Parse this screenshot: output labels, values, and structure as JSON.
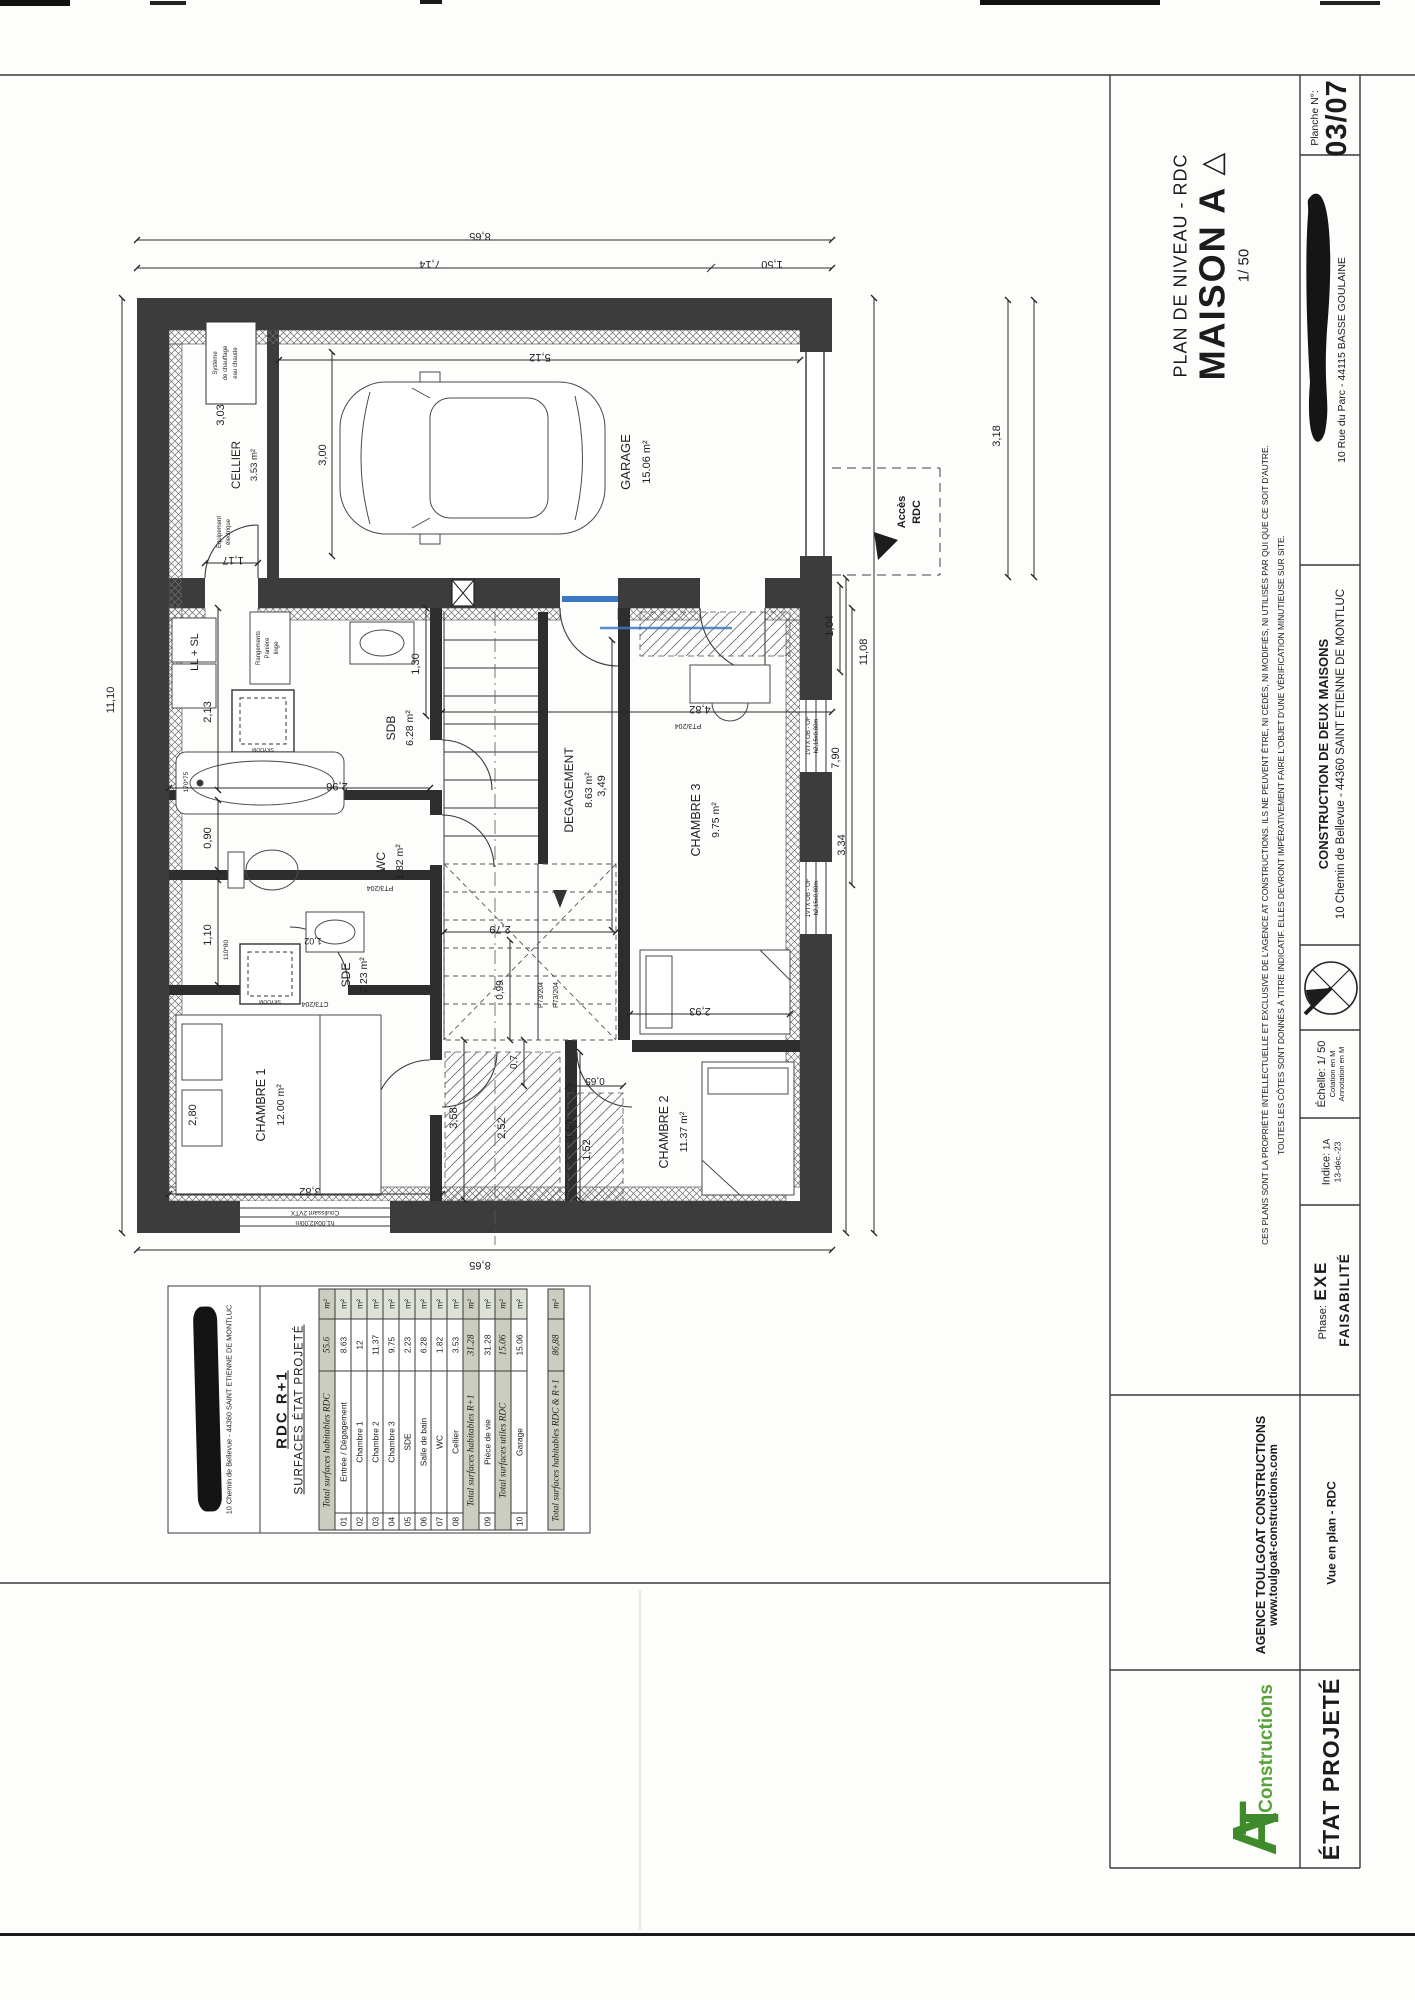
{
  "titleblock": {
    "title_small": "PLAN DE NIVEAU - RDC",
    "title_big": "MAISON A",
    "triangle": "△",
    "scale": "1/ 50",
    "planche_label": "Planche N°:",
    "planche_value": "03/07",
    "site_address": "10 Rue du Parc - 44115 BASSE GOULAINE",
    "project_title": "CONSTRUCTION DE DEUX MAISONS",
    "project_address": "10 Chemin de Bellevue - 44360 SAINT ETIENNE DE MONTLUC",
    "disclaimer_1": "CES PLANS SONT LA PROPRIÉTÉ INTELLECTUELLE ET EXCLUSIVE DE L'AGENCE AT CONSTRUCTIONS. ILS NE PEUVENT ÊTRE, NI CÉDÉS, NI MODIFIÉS, NI UTILISÉS PAR QUI QUE CE SOIT D'AUTRE.",
    "disclaimer_2": "TOUTES LES CÔTES SONT DONNÉS À TITRE INDICATIF. ELLES DEVRONT IMPÉRATIVEMENT FAIRE L'OBJET D'UNE VÉRIFICATION MINUTIEUSE SUR SITE.",
    "echelle_label": "Échelle:",
    "echelle_value": "1/ 50",
    "cotation": "Cotation en M",
    "annotation": "Annotation en M",
    "indice_label": "Indice:",
    "indice_value": "1A",
    "indice_date": "13-déc.-23",
    "phase_label": "Phase:",
    "phase_value": "EXE",
    "status": "FAISABILITÉ",
    "agency_name": "AGENCE TOULGOAT CONSTRUCTIONS",
    "agency_site": "www.toulgoat-constructions.com",
    "logo_a": "A",
    "logo_t": "T",
    "logo_sub": "Constructions",
    "doc_type": "ÉTAT PROJETÉ",
    "view_name": "Vue en plan - RDC"
  },
  "surface_table": {
    "client_address": "10 Chemin de Bellevue - 44360 SAINT ETIENNE DE MONTLUC",
    "heading_main": "RDC  R+1",
    "heading_sub": "SURFACES ÉTAT PROJETÉ",
    "sections": [
      {
        "label": "Total surfaces habitables RDC",
        "value": "55.6",
        "unit": "m²",
        "separated": false,
        "rows": [
          [
            "01",
            "Entrée / Dégagement",
            "8.63",
            "m²"
          ],
          [
            "02",
            "Chambre 1",
            "12",
            "m²"
          ],
          [
            "03",
            "Chambre 2",
            "11.37",
            "m²"
          ],
          [
            "04",
            "Chambre 3",
            "9.75",
            "m²"
          ],
          [
            "05",
            "SDE",
            "2.23",
            "m²"
          ],
          [
            "06",
            "Salle de bain",
            "6.28",
            "m²"
          ],
          [
            "07",
            "WC",
            "1.82",
            "m²"
          ],
          [
            "08",
            "Cellier",
            "3.53",
            "m²"
          ]
        ]
      },
      {
        "label": "Total surfaces habitables R+1",
        "value": "31.28",
        "unit": "m²",
        "separated": false,
        "rows": [
          [
            "09",
            "Pièce de vie",
            "31.28",
            "m²"
          ]
        ]
      },
      {
        "label": "Total surfaces utiles RDC",
        "value": "15.06",
        "unit": "m²",
        "separated": false,
        "rows": [
          [
            "10",
            "Garage",
            "15.06",
            "m²"
          ]
        ]
      },
      {
        "label": "Total surfaces habitables RDC & R+1",
        "value": "86,88",
        "unit": "m²",
        "separated": true,
        "rows": []
      }
    ]
  },
  "plan": {
    "rooms": {
      "garage": {
        "name": "GARAGE",
        "area": "15.06 m²"
      },
      "cellier": {
        "name": "CELLIER",
        "area": "3.53 m²"
      },
      "sdb": {
        "name": "SDB",
        "area": "6.28 m²"
      },
      "wc": {
        "name": "WC",
        "area": "1.82 m²"
      },
      "sde": {
        "name": "SDE",
        "area": "2.23 m²"
      },
      "degagement": {
        "name": "DEGAGEMENT",
        "area": "8.63 m²"
      },
      "chambre1": {
        "name": "CHAMBRE 1",
        "area": "12.00 m²"
      },
      "chambre2": {
        "name": "CHAMBRE 2",
        "area": "11.37 m²"
      },
      "chambre3": {
        "name": "CHAMBRE 3",
        "area": "9.75 m²"
      }
    },
    "dims": {
      "top_total": "8,65",
      "top_left": "7,14",
      "top_right": "1,50",
      "left_total": "11,10",
      "bottom_total": "8,65",
      "right_total": "11,08",
      "right_wing": "7,90",
      "right_ch3": "3,34",
      "entry_door": "1,04",
      "setback": "3,18",
      "garage_width": "5,12",
      "garage_depth": "3,00",
      "cellier_len": "3,03",
      "cellier_wid": "1,17",
      "sdb_depth": "2,13",
      "sdb_width": "2,96",
      "wc_width": "0,90",
      "sde_width": "1,10",
      "sde_fixture": "1,02",
      "hall_width": "1,30",
      "hall_len": "3,49",
      "hall_total": "4,82",
      "stair_run": "2,79",
      "corr_a": "0,99",
      "corr_b": "0,7",
      "corr_c": "0,65",
      "corr_d": "3,58",
      "closet_a": "2,52",
      "closet_b": "1,52",
      "ch1_width": "3,82",
      "ch1_bed": "2,80",
      "ch2_len": "4,00",
      "ch3_bed": "2,93"
    },
    "annotations": {
      "acces_1": "Accès",
      "acces_2": "RDC",
      "heater_1": "Système",
      "heater_2": "de chauffage",
      "heater_3": "eau chaude",
      "elec_1": "Equipement",
      "elec_2": "électrique",
      "appliances": "LL + SL",
      "storage_1": "Rangements",
      "storage_2": "Panière",
      "storage_3": "linge",
      "skydome": "SKYDOM",
      "bathtub": "170*75",
      "shower": "110*80",
      "door_pt3": "PT3/204",
      "door_p73": "P73/204",
      "door_ct3": "CT3/204",
      "window_slide_1": "Coulissant 2VTX",
      "window_slide_2": "h1,00xl2,00m",
      "window_bedroom_1": "1VTX OB - OF",
      "window_bedroom_2": "h2,15x0,80m"
    }
  }
}
